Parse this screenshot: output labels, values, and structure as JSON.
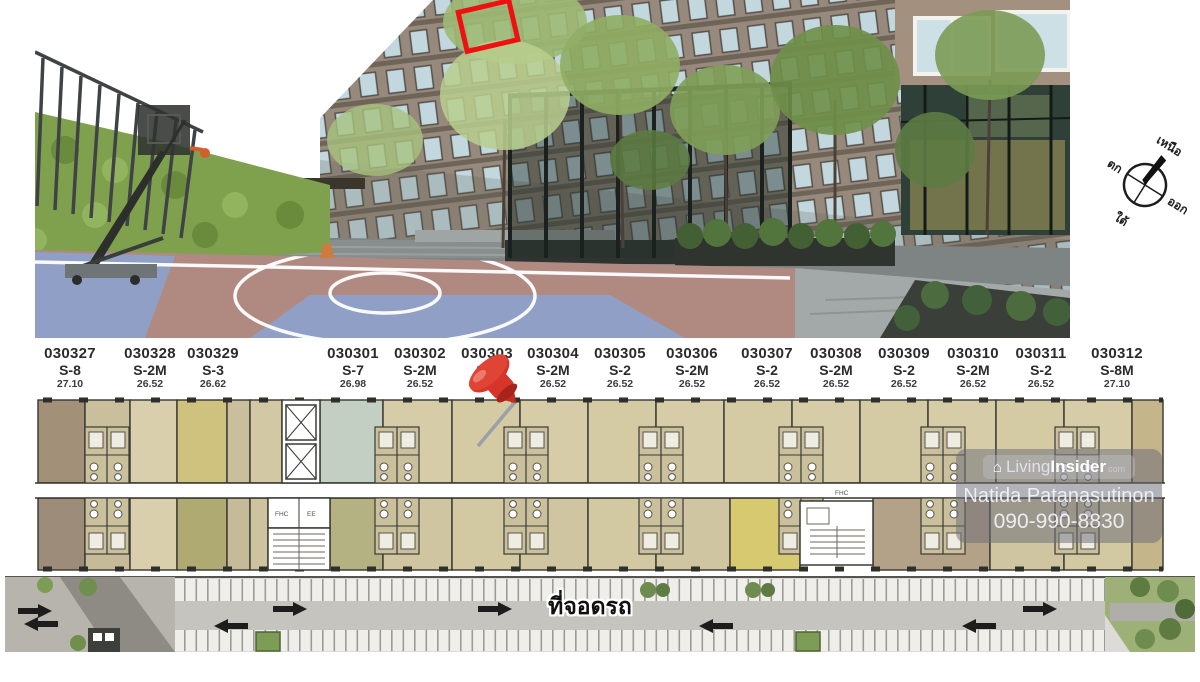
{
  "photo": {
    "description": "condo-courtyard-basketball-court-photo",
    "highlight_color": "#ee1111"
  },
  "compass": {
    "north": "เหนือ",
    "south": "ใต้",
    "east": "ออก",
    "west": "ตก"
  },
  "floor_plan": {
    "units": [
      {
        "number": "030327",
        "type": "S-8",
        "area": "27.10"
      },
      {
        "number": "030328",
        "type": "S-2M",
        "area": "26.52"
      },
      {
        "number": "030329",
        "type": "S-3",
        "area": "26.62"
      },
      {
        "number": "030301",
        "type": "S-7",
        "area": "26.98"
      },
      {
        "number": "030302",
        "type": "S-2M",
        "area": "26.52"
      },
      {
        "number": "030303",
        "type": "S-2",
        "area": "26.52"
      },
      {
        "number": "030304",
        "type": "S-2M",
        "area": "26.52"
      },
      {
        "number": "030305",
        "type": "S-2",
        "area": "26.52"
      },
      {
        "number": "030306",
        "type": "S-2M",
        "area": "26.52"
      },
      {
        "number": "030307",
        "type": "S-2",
        "area": "26.52"
      },
      {
        "number": "030308",
        "type": "S-2M",
        "area": "26.52"
      },
      {
        "number": "030309",
        "type": "S-2",
        "area": "26.52"
      },
      {
        "number": "030310",
        "type": "S-2M",
        "area": "26.52"
      },
      {
        "number": "030311",
        "type": "S-2",
        "area": "26.52"
      },
      {
        "number": "030312",
        "type": "S-8M",
        "area": "27.10"
      }
    ],
    "labels": {
      "fhc": "FHC",
      "ee": "EE"
    },
    "colors": {
      "tan": "#d4caa3",
      "khaki": "#cfc27f",
      "olive": "#aeaa72",
      "blue_gray": "#c3cfc2"
    }
  },
  "parking": {
    "label": "ที่จอดรถ"
  },
  "watermark": {
    "brand_living": "Living",
    "brand_insider": "Insider",
    "brand_suffix": "com",
    "house_glyph": "⌂",
    "name": "Natida Patanasutinon",
    "phone": "090-990-8830"
  }
}
